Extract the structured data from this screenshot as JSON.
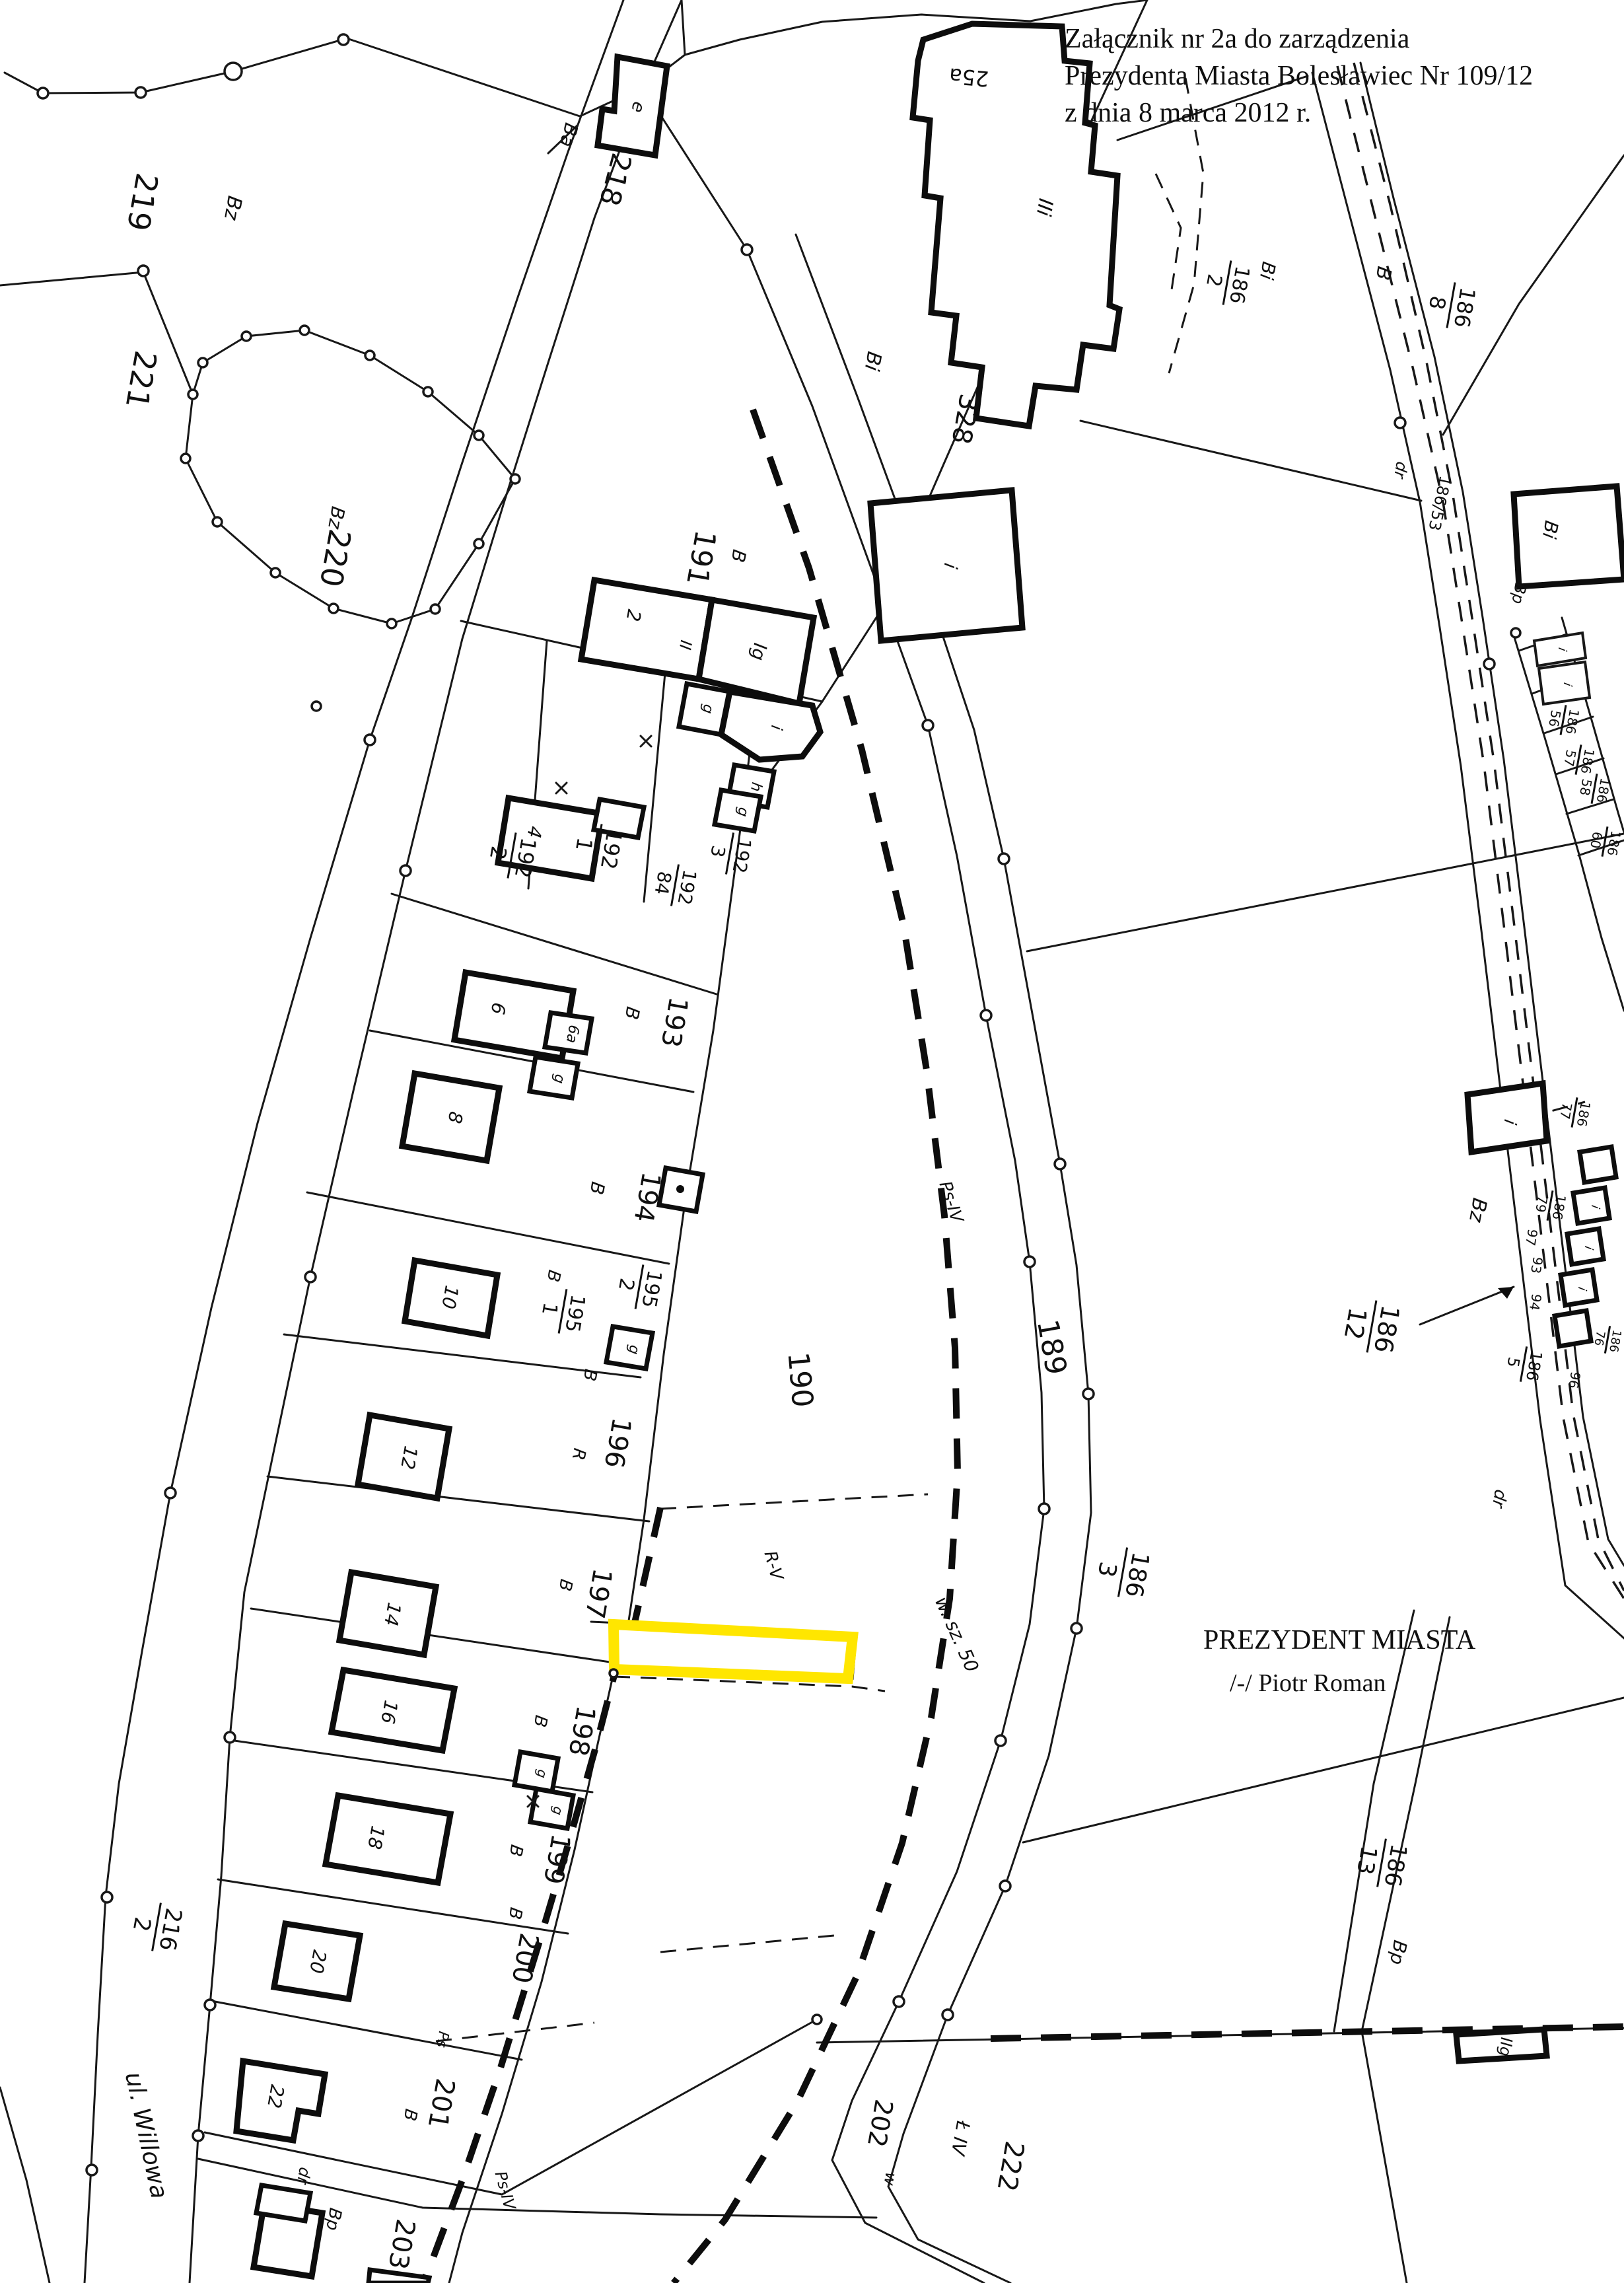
{
  "attachment_note": {
    "line1": "Załącznik nr 2a do zarządzenia",
    "line2": "Prezydenta Miasta Bolesławiec Nr 109/12",
    "line3": "z dnia 8 marca 2012 r."
  },
  "signature": {
    "title": "PREZYDENT MIASTA",
    "name": "/-/  Piotr Roman"
  },
  "street": {
    "name": "ul. Willowa"
  },
  "colors": {
    "highlight": "#ffe600",
    "ink": "#181818",
    "paper": "#ffffff"
  },
  "parcels": {
    "n219": "219",
    "n221": "221",
    "n220": "220",
    "n218": "218",
    "n191": "191",
    "n328": "328",
    "n189": "189",
    "n190": "190",
    "n193": "193",
    "n194": "194",
    "n196": "196",
    "n197": "197",
    "n198": "198",
    "n199": "199",
    "n200": "200",
    "n201": "201",
    "n202": "202",
    "n203": "203",
    "n222": "222",
    "n96": "96",
    "n97": "97",
    "n93": "93",
    "n94": "94"
  },
  "fractions": {
    "f192_1": {
      "num": "192",
      "den": "1"
    },
    "f192_2": {
      "num": "192",
      "den": "2"
    },
    "f192_3": {
      "num": "192",
      "den": "3"
    },
    "f192_84": {
      "num": "192",
      "den": "84"
    },
    "f195_1": {
      "num": "195",
      "den": "1"
    },
    "f195_2": {
      "num": "195",
      "den": "2"
    },
    "f216_2": {
      "num": "216",
      "den": "2"
    },
    "f186_2": {
      "num": "186",
      "den": "2"
    },
    "f186_8": {
      "num": "186",
      "den": "8"
    },
    "f186_3": {
      "num": "186",
      "den": "3"
    },
    "f186_12": {
      "num": "186",
      "den": "12"
    },
    "f186_13": {
      "num": "186",
      "den": "13"
    },
    "f186_5": {
      "num": "186",
      "den": "5"
    },
    "f186_56": {
      "num": "186",
      "den": "56"
    },
    "f186_57": {
      "num": "186",
      "den": "57"
    },
    "f186_58": {
      "num": "186",
      "den": "58"
    },
    "f186_60": {
      "num": "186",
      "den": "60"
    },
    "f186_77": {
      "num": "186",
      "den": "77"
    },
    "f186_79": {
      "num": "186",
      "den": "79"
    },
    "f186_76": {
      "num": "186",
      "den": "76"
    }
  },
  "codes": {
    "B": "B",
    "R": "R",
    "Bz": "Bz",
    "Bi": "Bi",
    "Bp": "Bp",
    "Ba": "Ba",
    "dr": "dr",
    "w": "w",
    "g": "g",
    "h": "h",
    "i": "i",
    "e": "e",
    "Ps": "Ps",
    "PsIV": "Ps-IV",
    "RV": "R-V",
    "LIV": "Ł IV",
    "wsz50": "w. sz. 50",
    "p18653": "186/53"
  },
  "houses": {
    "n4": "4",
    "n6": "6",
    "n6a": "6a",
    "n8": "8",
    "n10": "10",
    "n12": "12",
    "n14": "14",
    "n16": "16",
    "n18": "18",
    "n20": "20",
    "n22": "22"
  },
  "buildings": {
    "b25a": "25a",
    "bIIi": "IIi",
    "bIIg": "IIg",
    "c2": "2",
    "cII": "II",
    "cIg": "Ig"
  }
}
